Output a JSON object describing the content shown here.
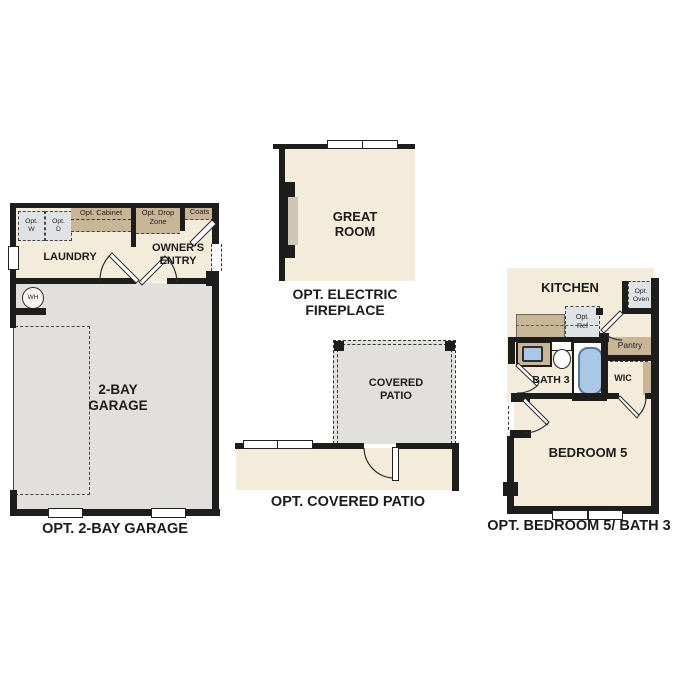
{
  "colors": {
    "wall": "#1d1d1b",
    "room": "#f3ecdb",
    "garage": "#e2e0dc",
    "cabinet": "#c9b697",
    "optbox": "#e0e3e6",
    "fixture": "#a9c8e6",
    "text": "#1c1c1c"
  },
  "sections": {
    "garage": {
      "caption": "OPT. 2-BAY GARAGE",
      "labels": {
        "laundry": "LAUNDRY",
        "owners_entry": "OWNER'S\nENTRY",
        "room": "2-BAY\nGARAGE",
        "opt_washer": "Opt.\nW",
        "opt_dryer": "Opt.\nD",
        "opt_cabinet": "Opt. Cabinet",
        "opt_drop_zone": "Opt. Drop\nZone",
        "coats": "Coats",
        "water_heater": "WH"
      }
    },
    "great_room": {
      "caption": "OPT. ELECTRIC\nFIREPLACE",
      "labels": {
        "room": "GREAT\nROOM"
      }
    },
    "patio": {
      "caption": "OPT. COVERED PATIO",
      "labels": {
        "room": "COVERED\nPATIO"
      }
    },
    "bedroom5": {
      "caption": "OPT. BEDROOM 5/ BATH 3",
      "labels": {
        "kitchen": "KITCHEN",
        "opt_oven": "Opt.\nOven",
        "opt_ref": "Opt.\nRef",
        "pantry": "Pantry",
        "bath": "BATH 3",
        "wic": "WIC",
        "room": "BEDROOM 5"
      }
    }
  }
}
